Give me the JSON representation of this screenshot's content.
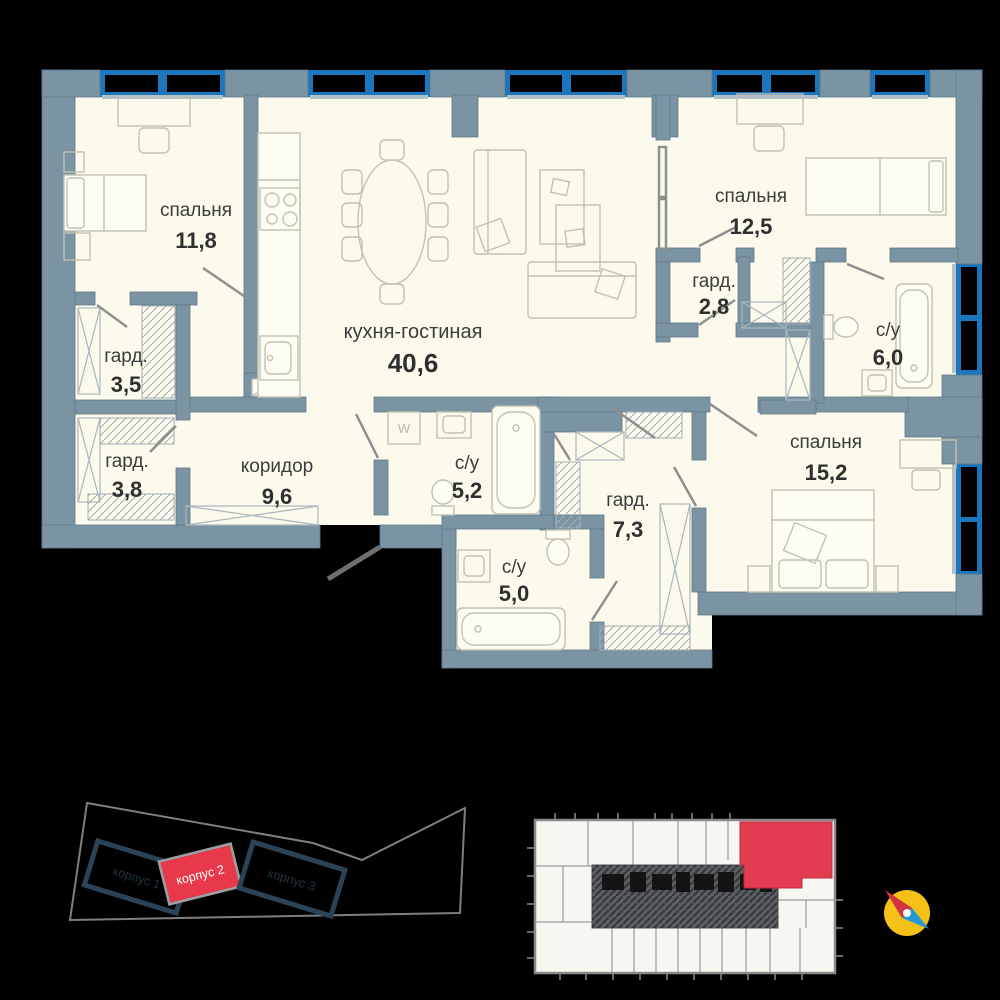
{
  "plan": {
    "rooms": [
      {
        "name": "спальня",
        "area": "11,8"
      },
      {
        "name": "гард.",
        "area": "3,5"
      },
      {
        "name": "гард.",
        "area": "3,8"
      },
      {
        "name": "коридор",
        "area": "9,6"
      },
      {
        "name": "кухня-гостиная",
        "area": "40,6"
      },
      {
        "name": "спальня",
        "area": "12,5"
      },
      {
        "name": "гард.",
        "area": "2,8"
      },
      {
        "name": "с/у",
        "area": "6,0"
      },
      {
        "name": "спальня",
        "area": "15,2"
      },
      {
        "name": "с/у",
        "area": "5,2"
      },
      {
        "name": "гард.",
        "area": "7,3"
      },
      {
        "name": "с/у",
        "area": "5,0"
      }
    ],
    "washer_label": "W"
  },
  "site_plan": {
    "buildings": [
      {
        "label": "корпус 1",
        "highlighted": false
      },
      {
        "label": "корпус 2",
        "highlighted": true
      },
      {
        "label": "корпус 3",
        "highlighted": false
      }
    ]
  },
  "colors": {
    "background": "#000000",
    "floor": "#fbfaec",
    "wall": "#7b94a3",
    "window_blue": "#1b76be",
    "furniture_line": "#c2c2b1",
    "label_text": "#3c3c3c",
    "accent_red": "#e8394b",
    "unit_red": "#e33c50",
    "korpus_navy": "#2b4355",
    "compass_yellow": "#f6c117",
    "compass_red": "#d43340",
    "compass_blue": "#2596d8"
  }
}
